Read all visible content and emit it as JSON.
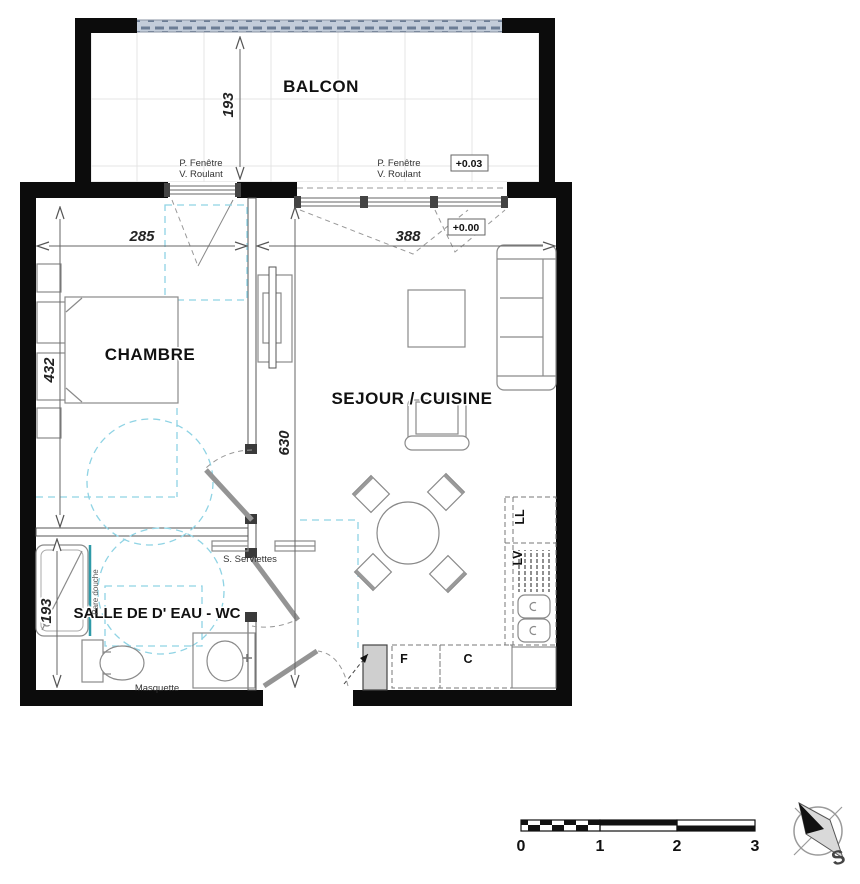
{
  "plan": {
    "rooms": {
      "balcony": "BALCON",
      "bedroom": "CHAMBRE",
      "living": "SEJOUR / CUISINE",
      "bathroom": "SALLE DE D' EAU - WC"
    },
    "window_labels": {
      "left": {
        "line1": "P. Fenêtre",
        "line2": "V. Roulant"
      },
      "right": {
        "line1": "P. Fenêtre",
        "line2": "V. Roulant"
      }
    },
    "levels": {
      "balcony": "+0.03",
      "interior": "+0.00"
    },
    "dimensions": {
      "balcony_depth": "193",
      "bedroom_width": "285",
      "living_width": "388",
      "bedroom_depth": "432",
      "living_depth": "630",
      "bathroom_depth": "193"
    },
    "equipment": {
      "towel_rail": "S. Serviettes",
      "shower_screen": "Pare douche",
      "masking": "Masquette",
      "washing_machine": "LL",
      "dishwasher": "LV",
      "fridge": "F",
      "cooking": "C"
    },
    "scale_bar": {
      "labels": [
        "0",
        "1",
        "2",
        "3"
      ]
    },
    "compass": {
      "south_label": "S"
    },
    "colors": {
      "wall": "#0c0c0c",
      "accessibility_dashed": "#8fd3e4",
      "railing_fill": "#c3cdda",
      "railing_dash": "#6b7d95",
      "shower_screen_line": "#2e9aa8"
    }
  }
}
